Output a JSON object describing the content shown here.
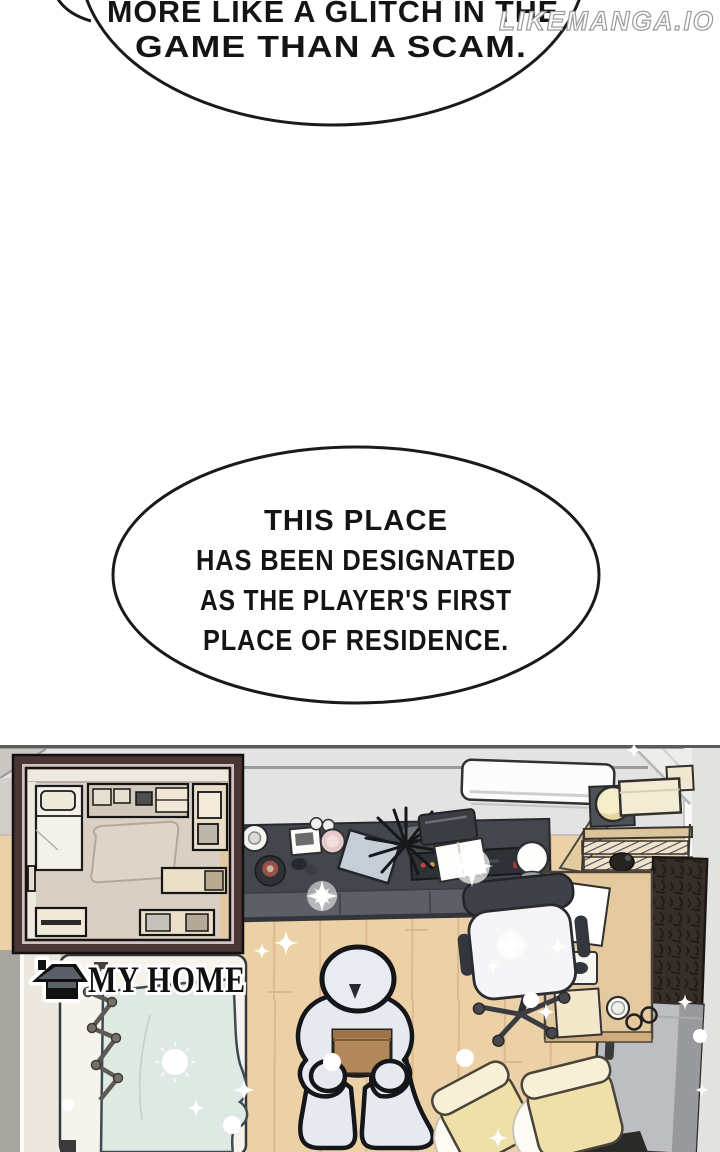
{
  "watermark": {
    "text": "LIKEMANGA.IO"
  },
  "speech_bubbles": [
    {
      "id": "bubble-1",
      "lines": [
        "MORE LIKE A GLITCH IN THE",
        "GAME THAN A SCAM."
      ]
    },
    {
      "id": "bubble-2",
      "lines": [
        "THIS PLACE",
        "HAS BEEN DESIGNATED",
        "AS THE PLAYER'S FIRST",
        "PLACE OF RESIDENCE."
      ]
    }
  ],
  "panel": {
    "label": {
      "text": "MY HOME",
      "icon": "house-icon"
    },
    "scene_objects": [
      "minimap-floor-plan",
      "air-conditioner",
      "wall-shelf",
      "hat-box",
      "wardrobe",
      "refrigerator",
      "sideboard",
      "potted-plant",
      "printer",
      "open-book",
      "laptop",
      "speaker",
      "office-chair",
      "desk",
      "paper-sheet",
      "mouse",
      "notebook",
      "mug",
      "glasses",
      "bed",
      "blanket",
      "drying-rack",
      "player-character",
      "cardboard-box",
      "floor-cushions",
      "sparkles"
    ],
    "colors": {
      "floor": "#edd1a6",
      "wall": "#e3e3e3",
      "minimap_border": "#4a3535",
      "minimap_bg": "#d9cfc3",
      "blanket": "#dfe9e4",
      "cushion": "#eee0a8",
      "character": "#e7e9f0",
      "box": "#b28759"
    }
  }
}
